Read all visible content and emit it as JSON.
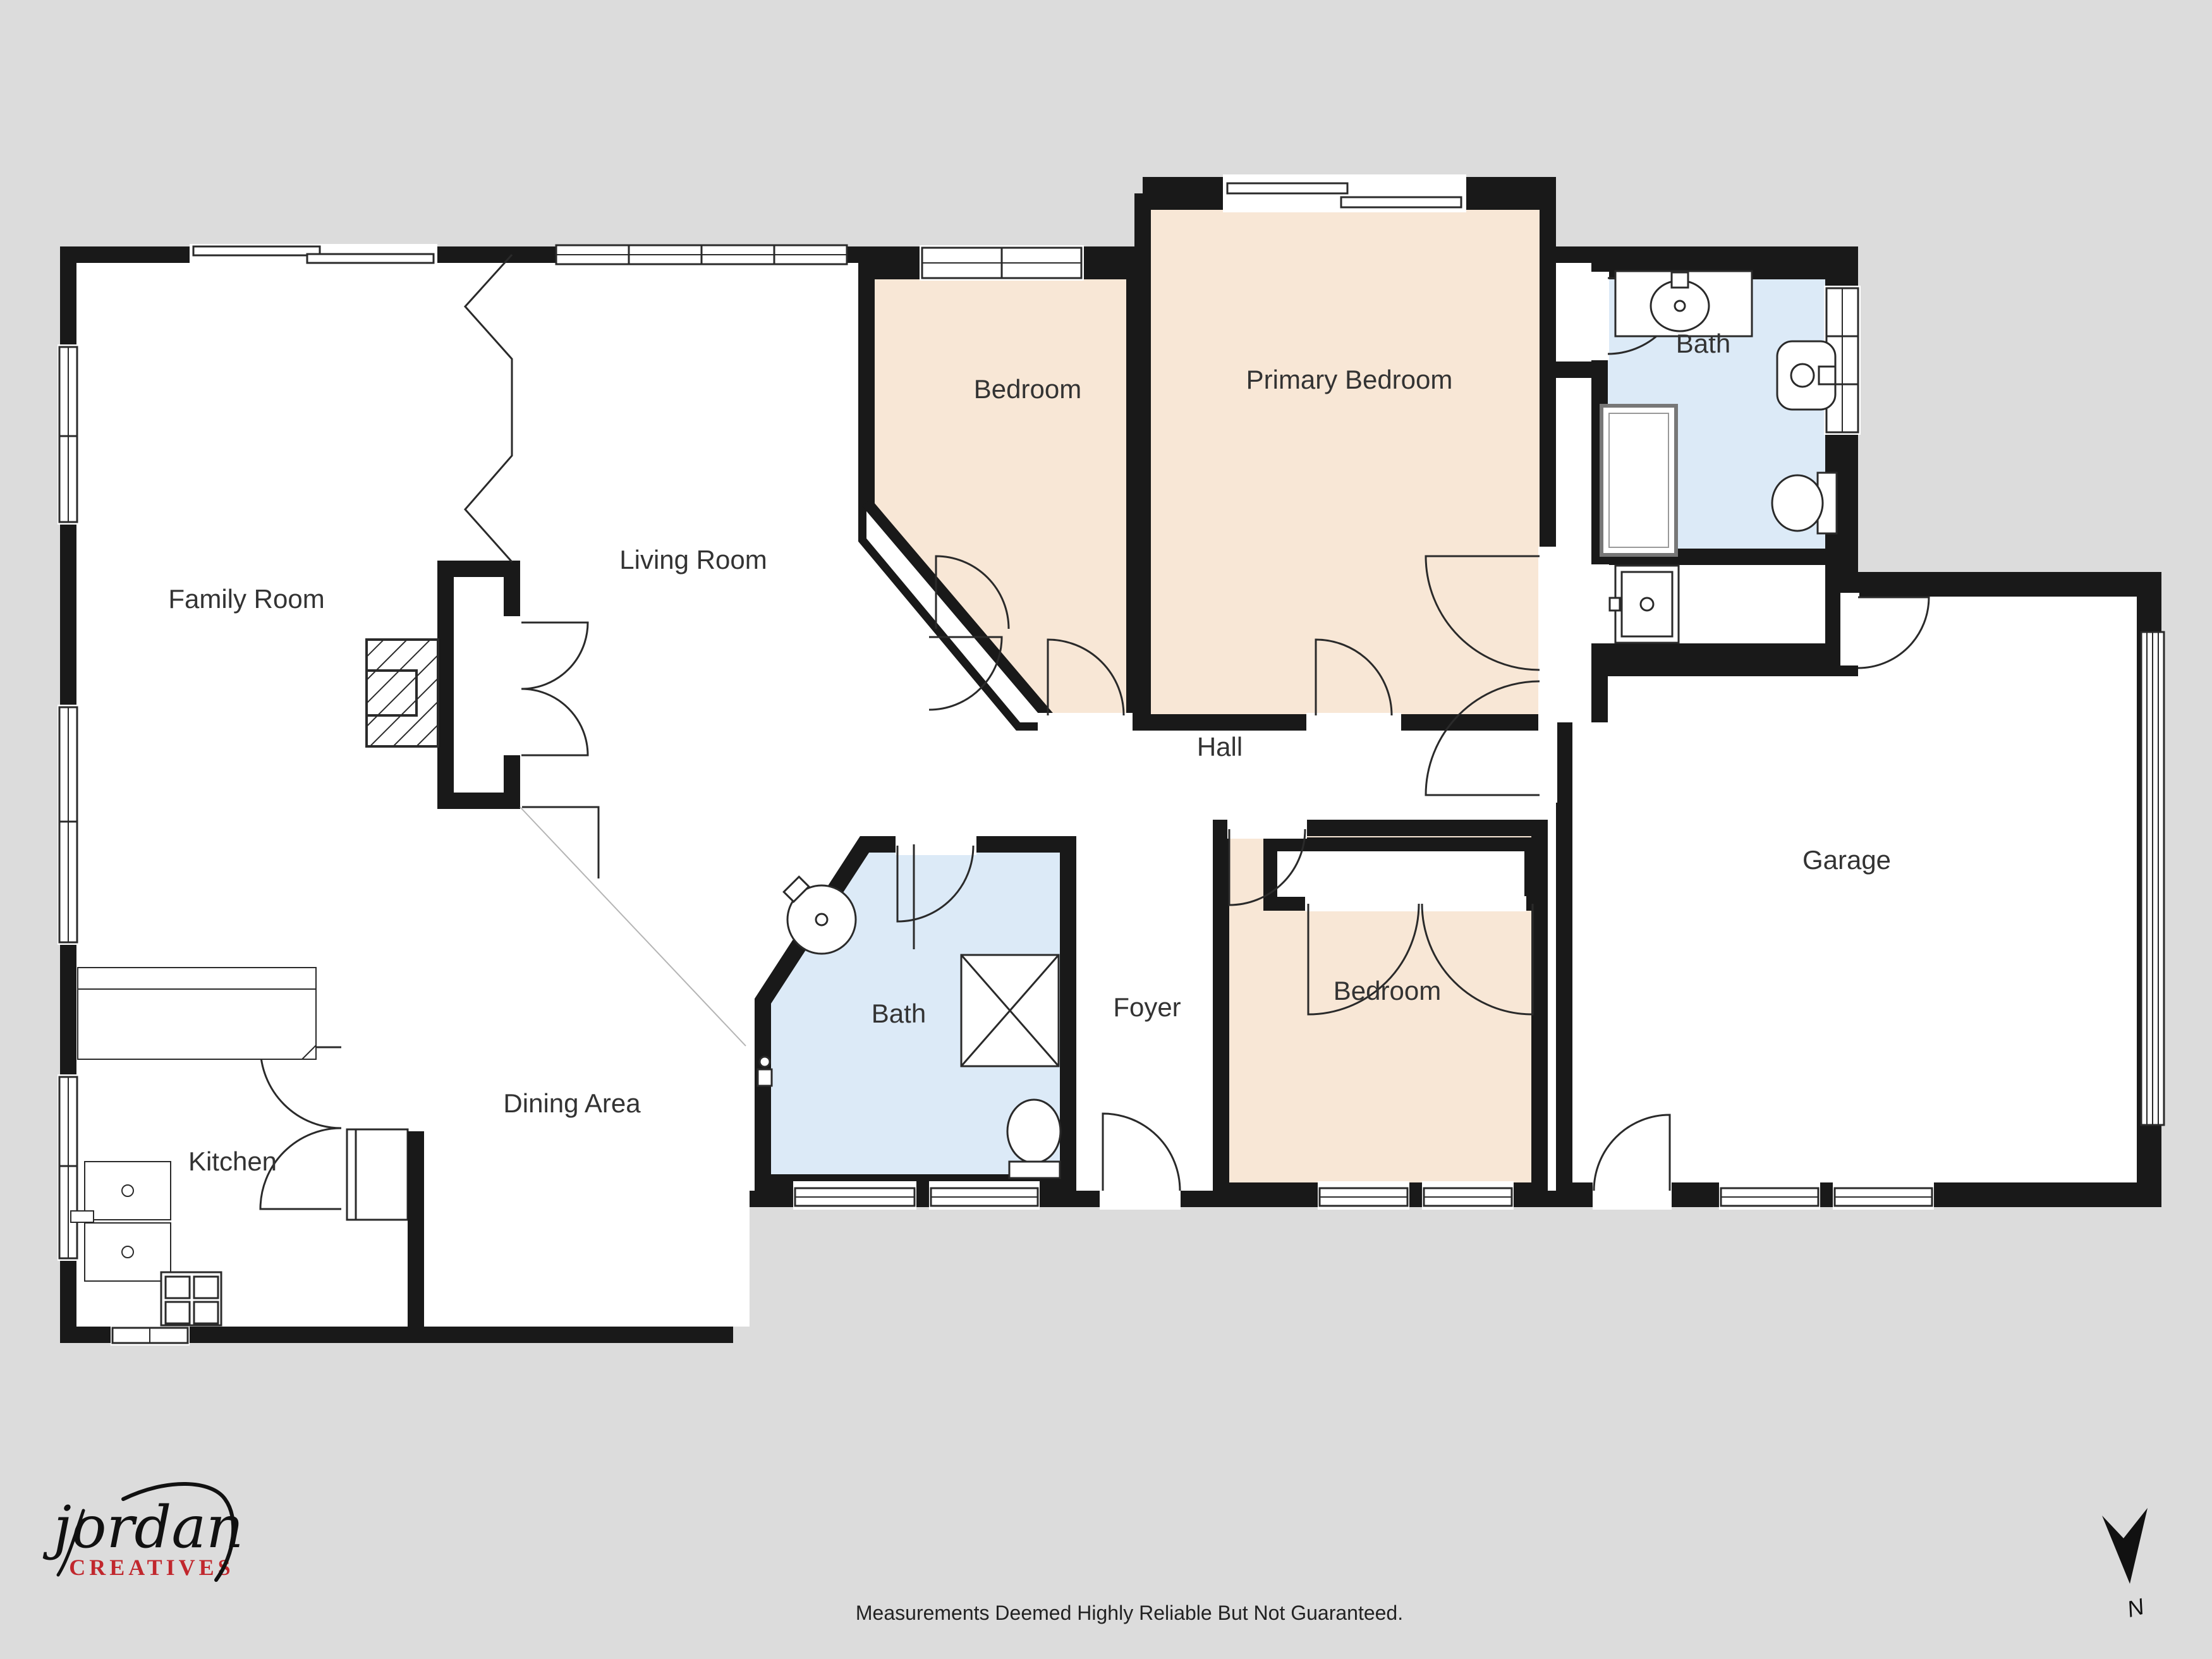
{
  "palette": {
    "background": "#dcdcdc",
    "wall": "#191919",
    "room_white": "#ffffff",
    "room_peach": "#f8e7d6",
    "room_blue": "#dceaf7",
    "line": "#2a2a2a",
    "label": "#333333",
    "logo_accent": "#c1272d"
  },
  "rooms": [
    {
      "name": "family-room",
      "label": "Family Room"
    },
    {
      "name": "living-room",
      "label": "Living Room"
    },
    {
      "name": "bedroom-top",
      "label": "Bedroom"
    },
    {
      "name": "primary-bedroom",
      "label": "Primary Bedroom"
    },
    {
      "name": "bath-top",
      "label": "Bath"
    },
    {
      "name": "hall",
      "label": "Hall"
    },
    {
      "name": "garage",
      "label": "Garage"
    },
    {
      "name": "bath-middle",
      "label": "Bath"
    },
    {
      "name": "foyer",
      "label": "Foyer"
    },
    {
      "name": "bedroom-bottom",
      "label": "Bedroom"
    },
    {
      "name": "dining-area",
      "label": "Dining Area"
    },
    {
      "name": "kitchen",
      "label": "Kitchen"
    }
  ],
  "footer": {
    "disclaimer": "Measurements Deemed Highly Reliable But Not Guaranteed."
  },
  "logo": {
    "name": "jordan",
    "tagline": "CREATIVES"
  },
  "compass": {
    "north_label": "N"
  }
}
